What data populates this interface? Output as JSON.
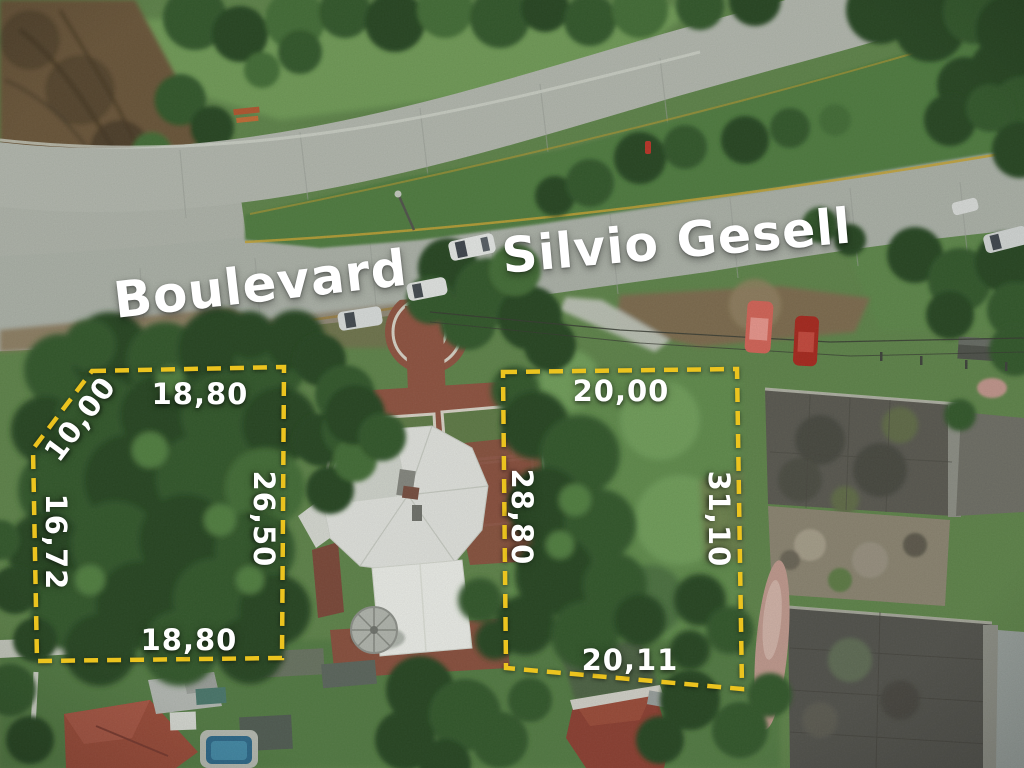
{
  "road_label": {
    "word1": "Boulevard",
    "word2": "Silvio Gesell",
    "text_color": "#ffffff"
  },
  "lots": {
    "outline_color": "#ecc41f",
    "measurement_text_color": "#ffffff",
    "left": {
      "id": "left-lot",
      "measurements": {
        "diagonal": "10,00",
        "top": "18,80",
        "left": "16,72",
        "right": "26,50",
        "bottom": "18,80"
      }
    },
    "right": {
      "id": "right-lot",
      "measurements": {
        "top": "20,00",
        "left": "28,80",
        "right": "31,10",
        "bottom": "20,11"
      }
    }
  }
}
